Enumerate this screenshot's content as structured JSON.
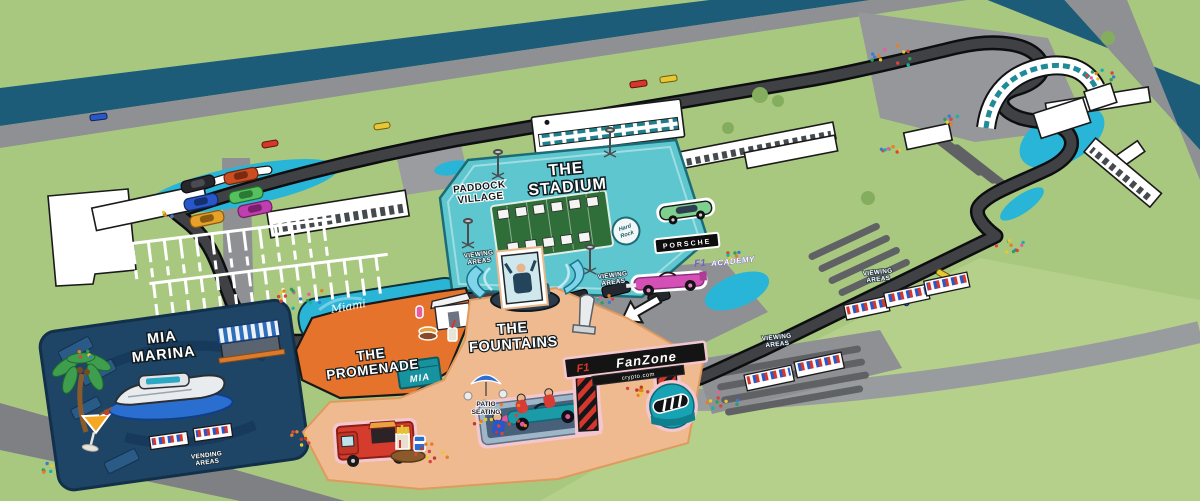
{
  "map_labels": {
    "stadium": {
      "l1": "THE",
      "l2": "STADIUM"
    },
    "paddock_village": {
      "l1": "PADDOCK",
      "l2": "VILLAGE"
    },
    "mia_marina": {
      "l1": "MIA",
      "l2": "MARINA"
    },
    "promenade": {
      "l1": "THE",
      "l2": "PROMENADE"
    },
    "fountains": {
      "l1": "THE",
      "l2": "FOUNTAINS"
    },
    "viewing_areas": {
      "l1": "VIEWING",
      "l2": "AREAS"
    },
    "vending_areas": {
      "l1": "VENDING",
      "l2": "AREAS"
    },
    "patio_seating": {
      "l1": "PATIO",
      "l2": "SEATING"
    },
    "fanzone_banner": {
      "f1_mark": "F1",
      "brand": "FanZone",
      "sponsor": "crypto.com"
    },
    "porsche_sign": "PORSCHE",
    "f1_academy": {
      "f1_mark": "F1",
      "name": "ACADEMY"
    },
    "mia_sign": "MIA",
    "miami_pool_script": "Miami",
    "hard_rock": {
      "l1": "Hard",
      "l2": "Rock"
    }
  },
  "colors": {
    "grass": "#a9c87f",
    "lawn": "#b5d08a",
    "canal": "#1d5c79",
    "road": "#8e9093",
    "track": "#3f4144",
    "runoff": "#29b5d7",
    "stadium_teal": "#5ec6ce",
    "marina_navy": "#1e4566",
    "promenade_orange": "#e5732b",
    "fountains_peach": "#efba90",
    "fanzone_red": "#d6372c",
    "helmet_teal": "#17a3b4",
    "academy_pink": "#d44fb6",
    "porsche_green": "#7ed08f"
  },
  "crowd_clusters": [
    {
      "x": 298,
      "y": 296,
      "r": 26,
      "n": 16,
      "warm": false
    },
    {
      "x": 168,
      "y": 213,
      "r": 8,
      "n": 5,
      "warm": false
    },
    {
      "x": 500,
      "y": 418,
      "r": 30,
      "n": 18,
      "warm": true
    },
    {
      "x": 432,
      "y": 452,
      "r": 18,
      "n": 10,
      "warm": true
    },
    {
      "x": 300,
      "y": 438,
      "r": 14,
      "n": 8,
      "warm": true
    },
    {
      "x": 640,
      "y": 390,
      "r": 14,
      "n": 9,
      "warm": true
    },
    {
      "x": 722,
      "y": 400,
      "r": 18,
      "n": 10,
      "warm": false
    },
    {
      "x": 893,
      "y": 57,
      "r": 22,
      "n": 12,
      "warm": false
    },
    {
      "x": 1102,
      "y": 78,
      "r": 16,
      "n": 9,
      "warm": false
    },
    {
      "x": 1012,
      "y": 244,
      "r": 16,
      "n": 10,
      "warm": false
    },
    {
      "x": 733,
      "y": 255,
      "r": 10,
      "n": 6,
      "warm": false
    },
    {
      "x": 890,
      "y": 148,
      "r": 12,
      "n": 8,
      "warm": false
    },
    {
      "x": 950,
      "y": 120,
      "r": 10,
      "n": 6,
      "warm": false
    },
    {
      "x": 86,
      "y": 354,
      "r": 8,
      "n": 5,
      "warm": false
    },
    {
      "x": 45,
      "y": 468,
      "r": 10,
      "n": 6,
      "warm": false
    },
    {
      "x": 605,
      "y": 300,
      "r": 10,
      "n": 7,
      "warm": false
    }
  ]
}
